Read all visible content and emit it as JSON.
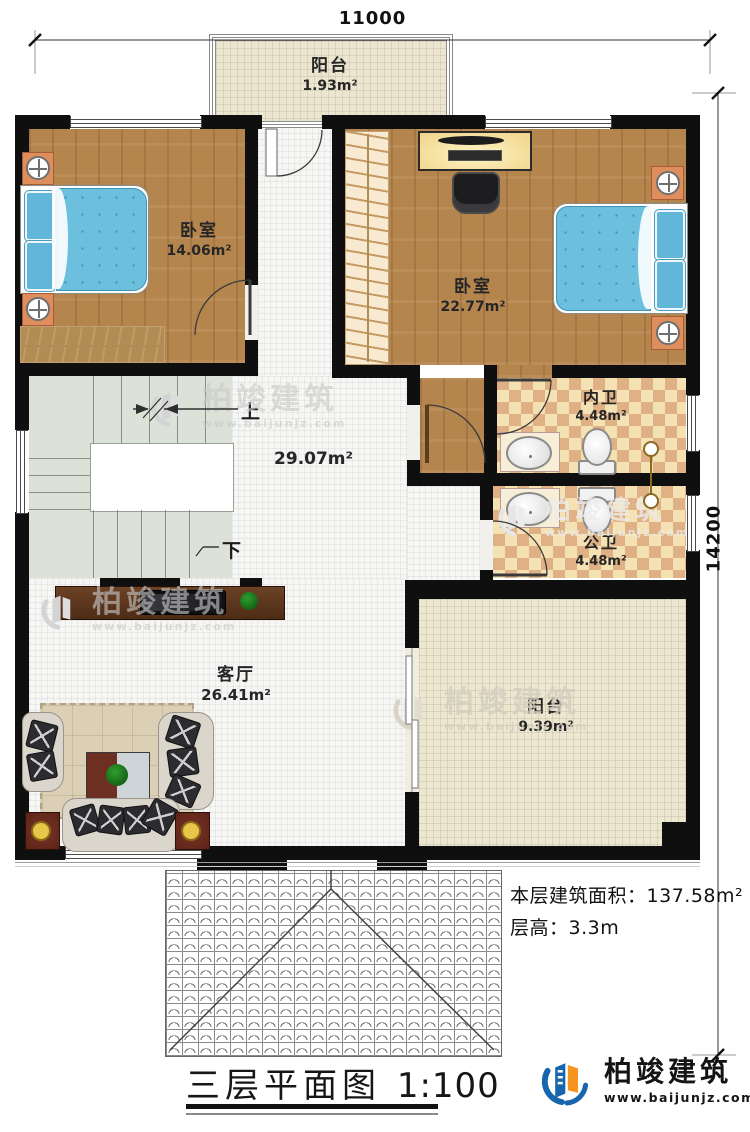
{
  "dimensions": {
    "width_top": "11000",
    "height_right": "14200"
  },
  "rooms": {
    "balcony_top": {
      "name": "阳台",
      "area": "1.93m²"
    },
    "bedroom_left": {
      "name": "卧室",
      "area": "14.06m²"
    },
    "bedroom_right": {
      "name": "卧室",
      "area": "22.77m²"
    },
    "bath_inner": {
      "name": "内卫",
      "area": "4.48m²"
    },
    "bath_public": {
      "name": "公卫",
      "area": "4.48m²"
    },
    "hall": {
      "area": "29.07m²"
    },
    "living": {
      "name": "客厅",
      "area": "26.41m²"
    },
    "balcony_bottom": {
      "name": "阳台",
      "area": "9.39m²"
    }
  },
  "stairs": {
    "up_label": "上",
    "down_label": "下"
  },
  "notes": {
    "floor_area_label": "本层建筑面积：",
    "floor_area_value": "137.58m²",
    "floor_height_label": "层高：",
    "floor_height_value": "3.3m"
  },
  "footer": {
    "title": "三层平面图",
    "scale": "1:100"
  },
  "brand": {
    "name": "柏竣建筑",
    "url": "www.baijunjz.com"
  },
  "watermark": {
    "name": "柏竣建筑",
    "url": "www.baijunjz.com"
  },
  "colors": {
    "wall": "#0f0f0f",
    "wood_floor": "#b5854e",
    "bed_blue": "#6cc0dd",
    "bath_tile_light": "#f5e2b4",
    "bath_tile_dark": "#dfb184",
    "brand_blue": "#1766ad",
    "brand_orange": "#f7941d"
  }
}
